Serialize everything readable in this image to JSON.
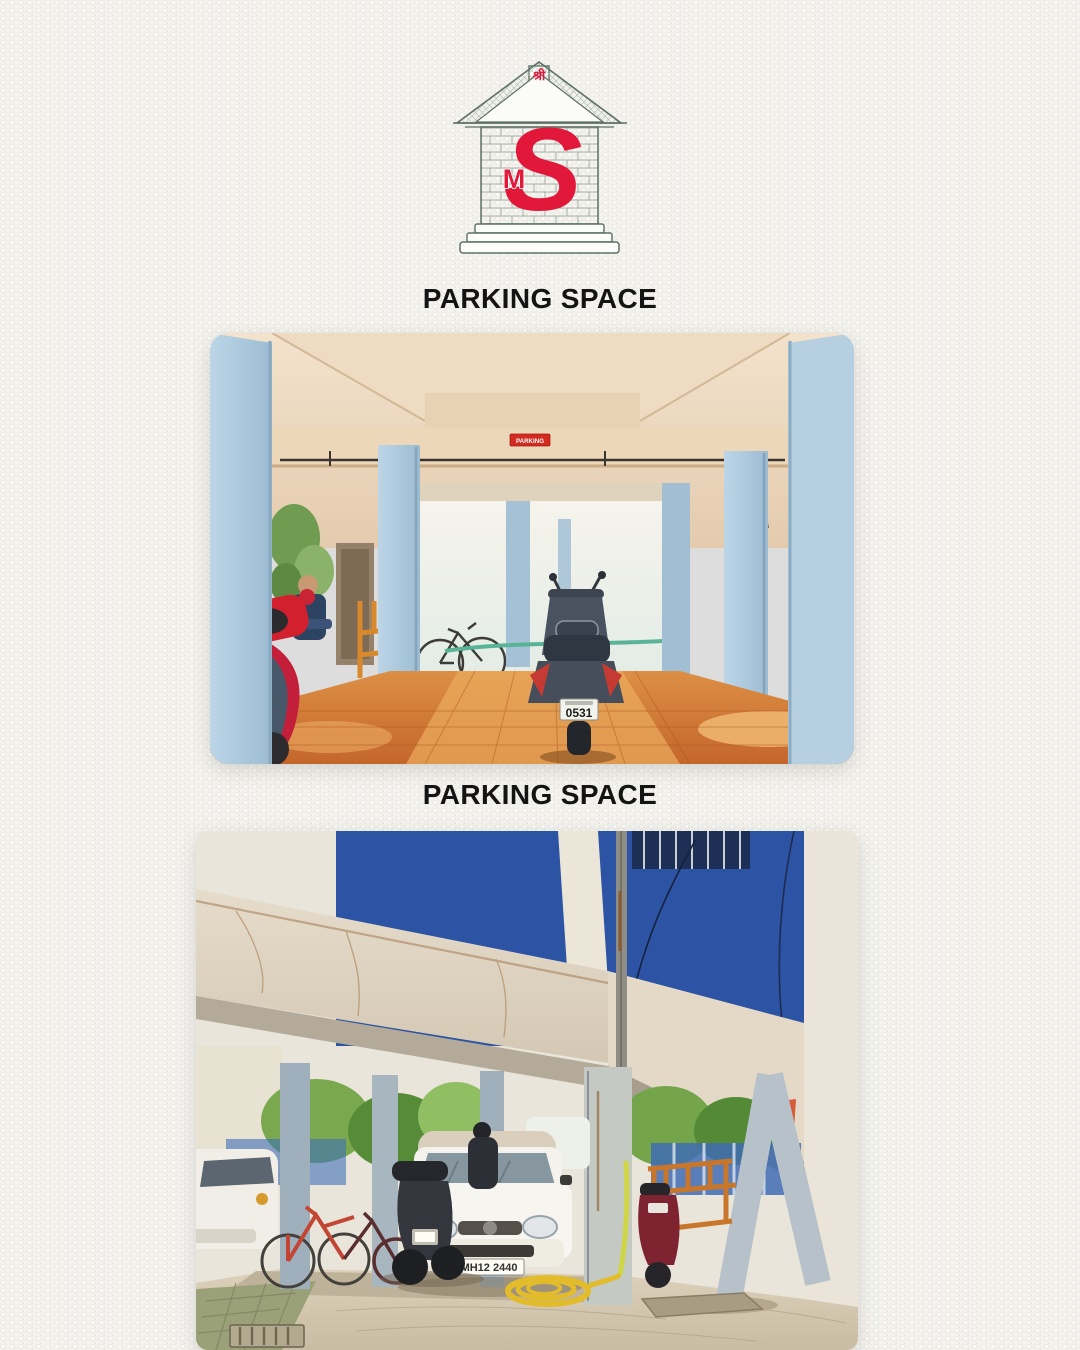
{
  "page": {
    "background": "#f2f1ec",
    "width": 1080,
    "height": 1350
  },
  "logo": {
    "name": "SM house monogram logo",
    "top_text": "श्री",
    "monogram_s": "S",
    "monogram_m": "M",
    "accent_red": "#e2183a",
    "outline_color": "#5d7065"
  },
  "sections": [
    {
      "heading": "PARKING SPACE",
      "photo": {
        "description": "Covered stilt parking interior with light-blue pillars, orange tiled floor, dark scooter in centre, red scooter and seated person at left",
        "sign_label": "PARKING",
        "scooter_plate": "0531"
      }
    },
    {
      "heading": "PARKING SPACE",
      "photo": {
        "description": "Stilt parking below blue building with white hatchback, bicycles, motorbikes, wooden bench and coiled yellow hose",
        "car_plate": "MH12 2440"
      }
    }
  ]
}
